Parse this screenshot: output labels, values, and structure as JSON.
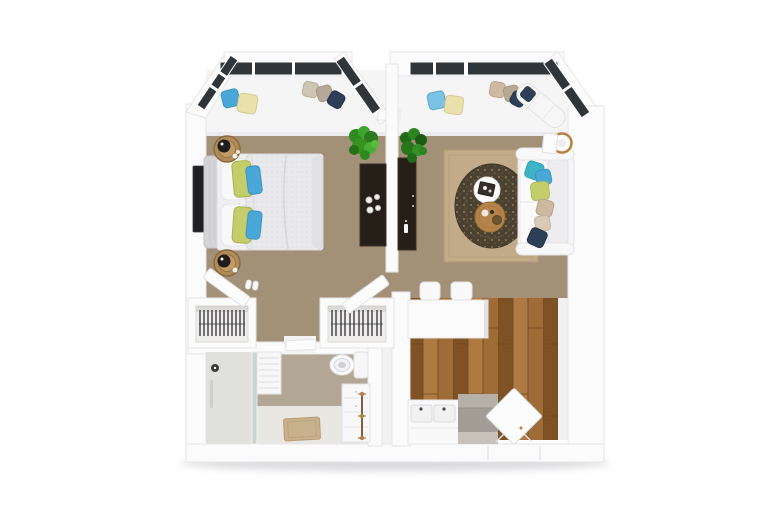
{
  "scene": {
    "description": "3D top-down rendered floor plan of a one-bedroom apartment",
    "view": "top-down",
    "background": "#ffffff"
  },
  "palette": {
    "wall": "#fbfbfc",
    "wall_edge": "#e6e6ea",
    "wall_shadow": "#dcdce1",
    "carpet": "#a39177",
    "bay_floor": "#f5f5f6",
    "wood_floor": "#9f6b36",
    "wood_floor_dark": "#7e5224",
    "wood_floor_light": "#ae7a42",
    "tile": "#b2a794",
    "tile_light": "#e9e7e1",
    "window_glass": "#30353a",
    "dark_furniture": "#261f18",
    "plant_green": "#2f8a22",
    "plant_green_dark": "#1f6b16",
    "accent_blue": "#4aa8d8",
    "accent_teal": "#3db4c6",
    "accent_green": "#c3cd6a",
    "accent_navy": "#2d3f56",
    "accent_cream": "#e9e0ac",
    "accent_tan": "#cbb9a1",
    "rug_beige": "#c1ab88",
    "rug_round_dark": "#4b4130",
    "wood_table": "#b5834a",
    "rattan": "#b08c59",
    "brass": "#b87f3f",
    "appliance_gray": "#a39e95",
    "bed_linen": "#f0f0f1",
    "duvet": "#e9e9ec",
    "bath_mat": "#c8b18d",
    "drop_shadow": "#b5b5ba"
  },
  "rooms": {
    "bedroom": {
      "furniture": [
        "double-bed",
        "headboard",
        "white-pillows",
        "green-accent-pillows",
        "blue-accent-pillows",
        "rattan-nightstand-with-lamp",
        "rattan-nightstand-with-lamp",
        "wall-tv",
        "media-console",
        "potted-plant",
        "bay-window-seat-pillows",
        "slippers"
      ]
    },
    "living_room": {
      "furniture": [
        "sofa",
        "sofa-accent-pillows",
        "beige-area-rug",
        "round-dark-rug",
        "white-round-coffee-table",
        "wood-round-coffee-table",
        "floor-lamp",
        "leaning-art-frame",
        "media-console",
        "potted-plant",
        "bay-window-chaise",
        "bay-window-seat-pillows"
      ]
    },
    "kitchen": {
      "furniture": [
        "breakfast-bar",
        "bar-stool",
        "bar-stool",
        "double-sink-counter",
        "gray-range-unit",
        "open-entry-door",
        "wood-plank-floor"
      ]
    },
    "bathroom": {
      "furniture": [
        "glass-shower",
        "shower-head",
        "louvered-shelf",
        "toilet",
        "vanity-cabinet",
        "towel-ladder",
        "bath-mat"
      ]
    },
    "closets": {
      "furniture": [
        "left-wardrobe-with-hangers",
        "right-wardrobe-with-hangers",
        "open-closet-door",
        "open-closet-door"
      ]
    },
    "hallway": {
      "furniture": [
        "bathroom-door-threshold"
      ]
    }
  }
}
